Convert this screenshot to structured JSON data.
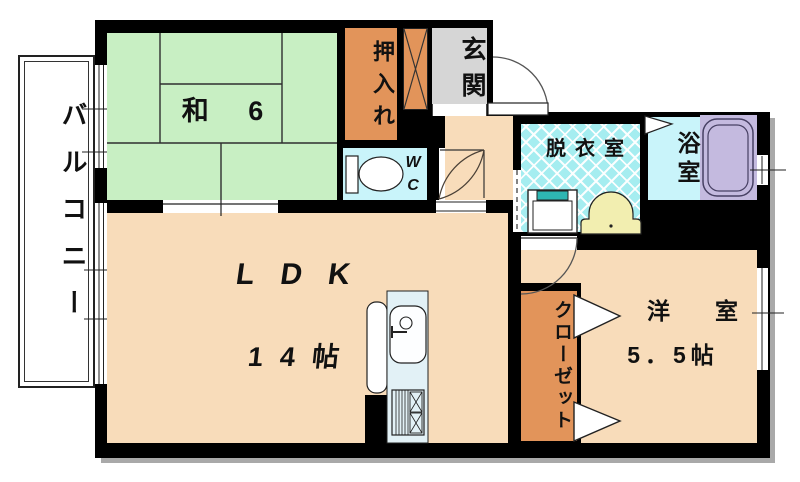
{
  "plan_title": "apartment-floor-plan",
  "colors": {
    "tatami_green": "#c8efc3",
    "floor_peach": "#f8dcba",
    "closet_orange": "#e2945a",
    "entry_gray": "#d6d6d6",
    "wet_cyan": "#c9f4fa",
    "lattice_cyan": "#a5edf0",
    "bathtub_purple": "#c4badf",
    "basin_yellow": "#f2eeb0",
    "washer_teal": "#2eb6b2"
  },
  "rooms": {
    "balcony": {
      "label": "バルコニー"
    },
    "japanese_room": {
      "label": "和 6"
    },
    "oshiire": {
      "label": "押入れ"
    },
    "entrance": {
      "label": "玄関"
    },
    "toilet": {
      "line1": "W",
      "line2": "C"
    },
    "ldk": {
      "label": "LDK",
      "size": "14帖"
    },
    "dressing_room": {
      "label": "脱衣室"
    },
    "bathroom": {
      "label": "浴室"
    },
    "closet": {
      "label": "クローゼット"
    },
    "western_room": {
      "label": "洋室",
      "size": "5．5帖"
    }
  },
  "fixtures": [
    "toilet-icon",
    "kitchen-sink-icon",
    "gas-stove-icon",
    "counter-icon",
    "washing-machine-icon",
    "wash-basin-icon",
    "bathtub-icon",
    "entrance-door-swing-icon",
    "room-door-swing-icon",
    "wc-door-swing-icon",
    "bath-folding-door-icon",
    "closet-door-triangles-icon",
    "window-icon",
    "sliding-door-opening-icon",
    "tatami-grid-icon",
    "x-hatch-storage-icon"
  ]
}
